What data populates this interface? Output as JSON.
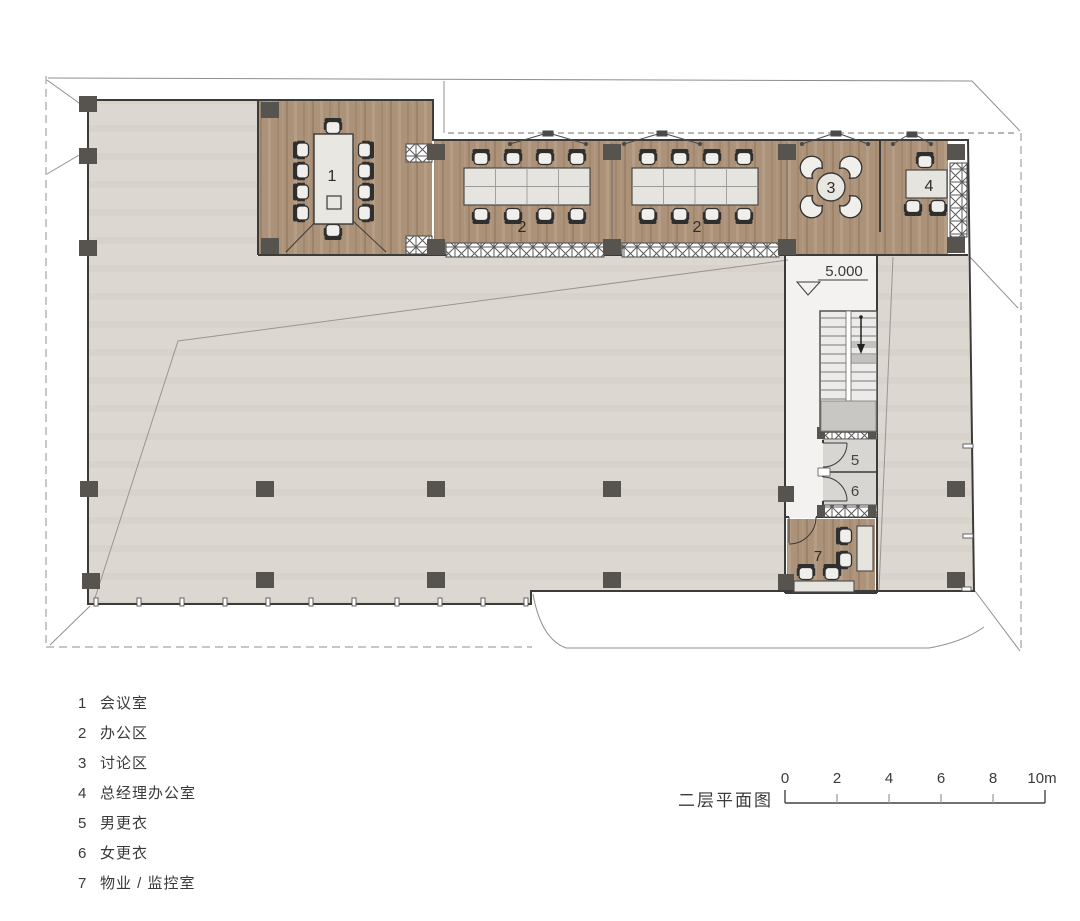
{
  "plan": {
    "title": "二层平面图",
    "elevation_marker": "5.000",
    "rooms": {
      "meeting": "1",
      "office": "2",
      "discussion": "3",
      "manager": "4",
      "men_changing": "5",
      "women_changing": "6",
      "property": "7"
    },
    "scale_bar": {
      "ticks": [
        "0",
        "2",
        "4",
        "6",
        "8",
        "10m"
      ]
    }
  },
  "legend": {
    "items": [
      {
        "num": "1",
        "name": "会议室"
      },
      {
        "num": "2",
        "name": "办公区"
      },
      {
        "num": "3",
        "name": "讨论区"
      },
      {
        "num": "4",
        "name": "总经理办公室"
      },
      {
        "num": "5",
        "name": "男更衣"
      },
      {
        "num": "6",
        "name": "女更衣"
      },
      {
        "num": "7",
        "name": "物业 / 监控室"
      }
    ]
  },
  "colors": {
    "wood_floor": "#ab9279",
    "open_floor": "#dcd8d1",
    "column": "#57544f",
    "wall_line": "#3d3b38",
    "site_line": "#8f8f8f",
    "room_gray": "#d8d6d3",
    "text": "#3a3a3a"
  }
}
